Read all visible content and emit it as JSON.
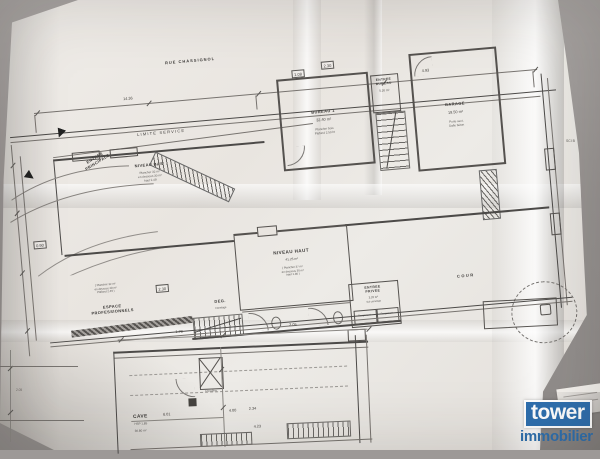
{
  "scene": {
    "background_color": "#9d9997",
    "paper_color": "#e9e5e0",
    "ink_color": "#4c4a48"
  },
  "branding": {
    "name": "tower",
    "tagline": "immobilier",
    "brand_color": "#2e6fae",
    "text_color": "#ffffff"
  },
  "plan": {
    "street_label": "RUE CHASSIGNOL",
    "boundary_label": "LIMITE SERVICE",
    "corner_ref": "SCI B",
    "rooms": {
      "bureau1": {
        "name": "BUREAU 1",
        "area": "32.40 m²",
        "note": "Plancher bois\nPlafond 2.50 ht"
      },
      "entree_bureau": {
        "name": "ENTREE\nBUREAU",
        "area": "5.20 m²"
      },
      "garage": {
        "name": "GARAGE",
        "area": "19.50 m²",
        "note": "Porte sect.\nDalle béton"
      },
      "niveau_bas": {
        "name": "NIVEAU BAS",
        "note": "Plancher 32 m²\nen dessous 30 m²\nhaut 2.49"
      },
      "niveau_haut": {
        "name": "NIVEAU HAUT",
        "area": "41.25 m²",
        "note": "( Plancher 37 m²\nen dessous 30 m²\nhaut 1.80 )"
      },
      "degagement": {
        "name": "DEG.",
        "note": "Carrelage"
      },
      "entree_privee": {
        "name": "ENTREE\nPRIVEE",
        "area": "3.20 m²",
        "note": "Sol carrelage"
      },
      "rangement_1": {
        "name": "Rangement"
      },
      "rangement_2": {
        "name": "Rangement"
      },
      "espace_pro": {
        "name": "ESPACE\nPROFESSIONNELS",
        "note": "( Plancher 32 m²\nen dessous 28 m²\nPlafond 2.49 )"
      },
      "cour": {
        "name": "COUR"
      },
      "cave": {
        "name": "CAVE",
        "hsp": "HSP 1,85",
        "area": "36.80 m²"
      },
      "chaudiere": {
        "name": "Chaudière"
      },
      "entree_principale": {
        "name": "ENTREE\nPRINCIPALE"
      }
    },
    "dimensions": [
      "14.36",
      "4.93",
      "2.30",
      "1.08",
      "6.01",
      "4.00",
      "2.34",
      "4.23",
      "1.78",
      "2.05",
      "0.90"
    ]
  }
}
